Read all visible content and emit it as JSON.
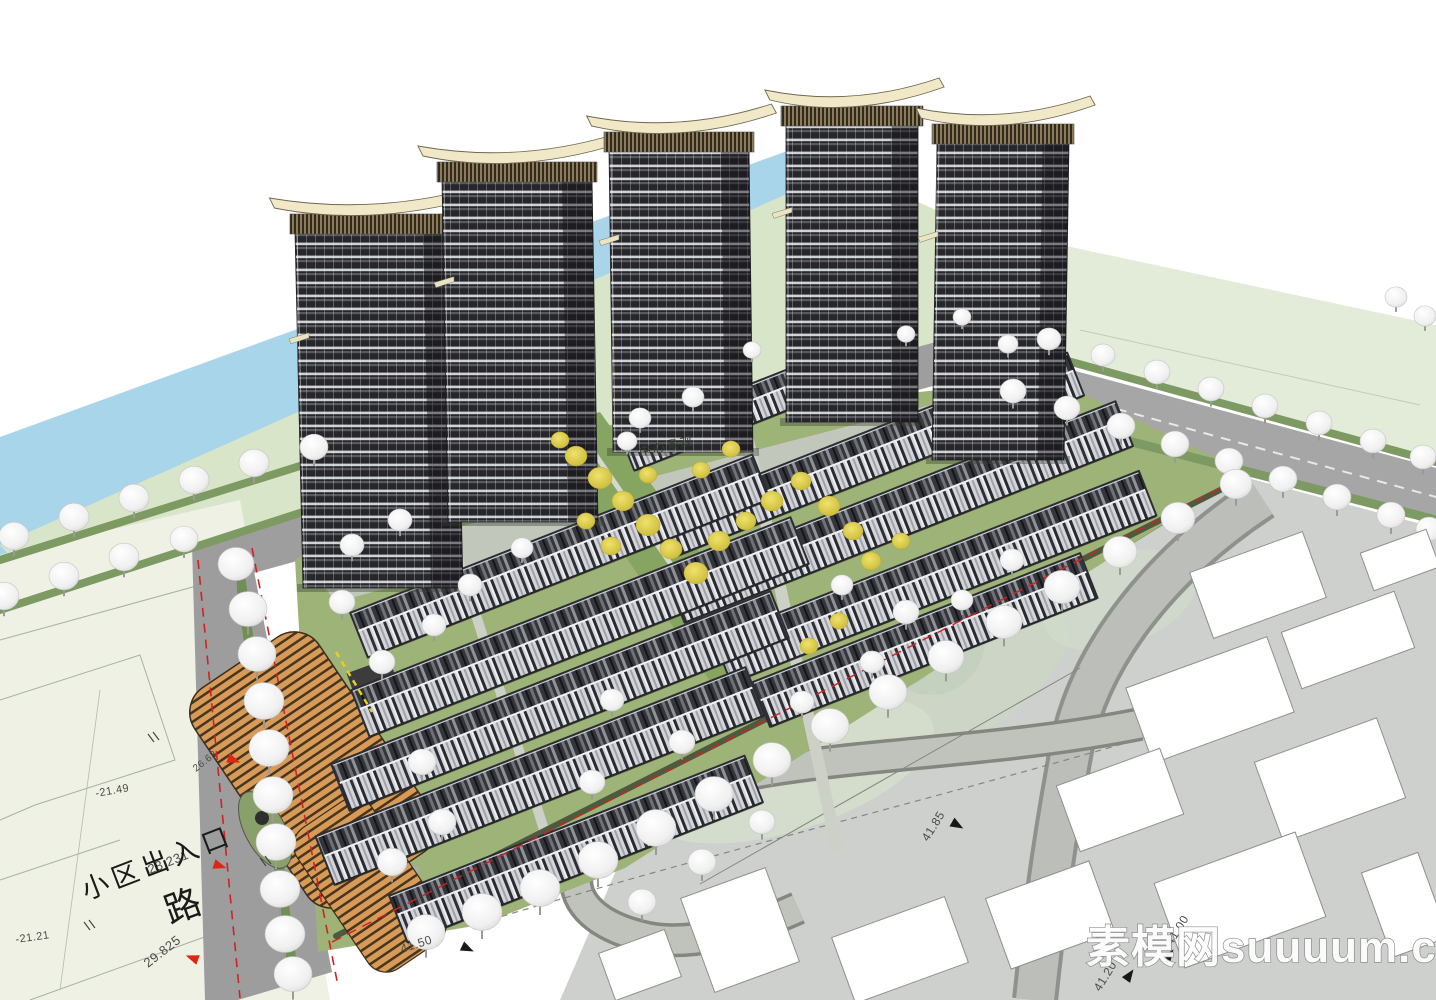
{
  "watermark": {
    "text": "素模网suuuum.com"
  },
  "labels": {
    "entrance": {
      "text": "小区出入口",
      "x": 86,
      "y": 900,
      "rot": -21,
      "size": 27
    },
    "road_char": {
      "text": "路",
      "x": 170,
      "y": 924,
      "rot": -20,
      "size": 36
    },
    "central": {
      "text": "中心景观",
      "x": 640,
      "y": 456,
      "rot": -12,
      "size": 12
    }
  },
  "elevations": [
    {
      "v": "-21.49",
      "x": 96,
      "y": 797,
      "rot": -10,
      "size": 11
    },
    {
      "v": "-21.21",
      "x": 16,
      "y": 943,
      "rot": -8,
      "size": 11
    },
    {
      "v": "28.231",
      "x": 150,
      "y": 874,
      "rot": -22,
      "size": 13,
      "tri": {
        "x": 214,
        "y": 864,
        "rot": 18,
        "c": "#e02515"
      }
    },
    {
      "v": "29.825",
      "x": 148,
      "y": 968,
      "rot": -38,
      "size": 13,
      "tri": {
        "x": 198,
        "y": 960,
        "rot": 200,
        "c": "#e02515"
      }
    },
    {
      "v": "26.63",
      "x": 196,
      "y": 772,
      "rot": -38,
      "size": 10,
      "tri": {
        "x": 228,
        "y": 758,
        "rot": 20,
        "c": "#e02515"
      }
    },
    {
      "v": "41.50",
      "x": 402,
      "y": 953,
      "rot": -18,
      "size": 12,
      "tri": {
        "x": 462,
        "y": 946,
        "rot": 25,
        "c": "#181818"
      }
    },
    {
      "v": "41.85",
      "x": 928,
      "y": 842,
      "rot": -58,
      "size": 12,
      "tri": {
        "x": 952,
        "y": 822,
        "rot": 30,
        "c": "#181818"
      }
    },
    {
      "v": "41.20",
      "x": 1100,
      "y": 992,
      "rot": -58,
      "size": 12,
      "tri": {
        "x": 1126,
        "y": 980,
        "rot": -55,
        "c": "#181818"
      }
    },
    {
      "v": "41.00",
      "x": 1172,
      "y": 946,
      "rot": -58,
      "size": 12,
      "tri": {
        "x": 1166,
        "y": 960,
        "rot": -55,
        "c": "#181818"
      }
    }
  ],
  "towers": [
    {
      "cx": 383,
      "w": 160,
      "base": 588,
      "top": 232,
      "lean": -8
    },
    {
      "cx": 523,
      "w": 150,
      "base": 522,
      "top": 180,
      "lean": -6
    },
    {
      "cx": 683,
      "w": 140,
      "base": 452,
      "top": 150,
      "lean": -4
    },
    {
      "cx": 852,
      "w": 132,
      "base": 422,
      "top": 124,
      "lean": 0
    },
    {
      "cx": 998,
      "w": 132,
      "base": 460,
      "top": 142,
      "lean": 5
    }
  ],
  "row_angle": -21.5,
  "townhouse_rows": [
    {
      "cx": 726,
      "cy": 414,
      "len": 210,
      "h": 36
    },
    {
      "cx": 870,
      "cy": 455,
      "len": 440,
      "h": 44
    },
    {
      "cx": 900,
      "cy": 512,
      "len": 480,
      "h": 46
    },
    {
      "cx": 935,
      "cy": 577,
      "len": 455,
      "h": 46
    },
    {
      "cx": 925,
      "cy": 640,
      "len": 350,
      "h": 46
    },
    {
      "cx": 560,
      "cy": 556,
      "len": 430,
      "h": 46
    },
    {
      "cx": 580,
      "cy": 627,
      "len": 470,
      "h": 48
    },
    {
      "cx": 560,
      "cy": 701,
      "len": 470,
      "h": 48
    },
    {
      "cx": 540,
      "cy": 776,
      "len": 460,
      "h": 50
    },
    {
      "cx": 576,
      "cy": 849,
      "len": 380,
      "h": 48
    }
  ],
  "footprint_angle": -20,
  "footprints": [
    [
      1258,
      585,
      120,
      70
    ],
    [
      1348,
      640,
      120,
      60
    ],
    [
      1210,
      700,
      150,
      80
    ],
    [
      1330,
      780,
      130,
      85
    ],
    [
      1120,
      800,
      110,
      70
    ],
    [
      1240,
      900,
      150,
      90
    ],
    [
      1050,
      915,
      110,
      75
    ],
    [
      900,
      950,
      120,
      70
    ],
    [
      740,
      930,
      90,
      100
    ],
    [
      640,
      965,
      70,
      50
    ],
    [
      1400,
      560,
      70,
      40
    ],
    [
      1405,
      905,
      60,
      90
    ]
  ],
  "trees_white": [
    [
      14,
      536,
      15
    ],
    [
      74,
      517,
      15
    ],
    [
      134,
      498,
      15
    ],
    [
      194,
      480,
      15
    ],
    [
      254,
      463,
      15
    ],
    [
      314,
      447,
      14
    ],
    [
      4,
      596,
      15
    ],
    [
      64,
      576,
      15
    ],
    [
      124,
      557,
      15
    ],
    [
      184,
      539,
      14
    ],
    [
      236,
      564,
      18
    ],
    [
      248,
      609,
      19
    ],
    [
      257,
      654,
      19
    ],
    [
      264,
      701,
      20
    ],
    [
      269,
      748,
      20
    ],
    [
      273,
      795,
      20
    ],
    [
      276,
      842,
      20
    ],
    [
      280,
      889,
      20
    ],
    [
      285,
      934,
      20
    ],
    [
      293,
      974,
      19
    ],
    [
      640,
      418,
      11
    ],
    [
      693,
      397,
      11
    ],
    [
      627,
      441,
      10
    ],
    [
      752,
      350,
      9
    ],
    [
      906,
      334,
      9
    ],
    [
      962,
      317,
      9
    ],
    [
      1008,
      344,
      10
    ],
    [
      1049,
      339,
      12
    ],
    [
      1103,
      355,
      12
    ],
    [
      1157,
      372,
      13
    ],
    [
      1211,
      389,
      13
    ],
    [
      1265,
      406,
      13
    ],
    [
      1319,
      423,
      13
    ],
    [
      1373,
      441,
      13
    ],
    [
      1423,
      457,
      13
    ],
    [
      1396,
      297,
      11
    ],
    [
      1425,
      316,
      11
    ],
    [
      1013,
      391,
      13
    ],
    [
      1067,
      408,
      13
    ],
    [
      1121,
      426,
      14
    ],
    [
      1175,
      444,
      14
    ],
    [
      1229,
      461,
      14
    ],
    [
      1283,
      479,
      14
    ],
    [
      1337,
      497,
      14
    ],
    [
      1391,
      515,
      14
    ],
    [
      1429,
      529,
      13
    ],
    [
      1236,
      484,
      16
    ],
    [
      1178,
      518,
      17
    ],
    [
      1120,
      552,
      17
    ],
    [
      1062,
      587,
      18
    ],
    [
      1004,
      622,
      18
    ],
    [
      946,
      657,
      18
    ],
    [
      888,
      692,
      19
    ],
    [
      830,
      726,
      19
    ],
    [
      772,
      760,
      19
    ],
    [
      714,
      794,
      19
    ],
    [
      656,
      828,
      20
    ],
    [
      598,
      860,
      20
    ],
    [
      540,
      888,
      20
    ],
    [
      482,
      912,
      20
    ],
    [
      426,
      932,
      19
    ],
    [
      906,
      612,
      13
    ],
    [
      1012,
      560,
      12
    ],
    [
      842,
      585,
      11
    ],
    [
      470,
      585,
      12
    ],
    [
      522,
      548,
      11
    ],
    [
      434,
      625,
      12
    ],
    [
      612,
      700,
      12
    ],
    [
      682,
      742,
      13
    ],
    [
      592,
      782,
      13
    ],
    [
      802,
      702,
      12
    ],
    [
      872,
      662,
      12
    ],
    [
      962,
      600,
      11
    ],
    [
      342,
      602,
      13
    ],
    [
      382,
      662,
      13
    ],
    [
      422,
      762,
      14
    ],
    [
      392,
      862,
      15
    ],
    [
      442,
      822,
      14
    ],
    [
      702,
      862,
      14
    ],
    [
      762,
      822,
      13
    ],
    [
      642,
      902,
      14
    ],
    [
      352,
      545,
      12
    ],
    [
      400,
      520,
      12
    ]
  ],
  "trees_yellow": [
    [
      576,
      456,
      11
    ],
    [
      600,
      478,
      12
    ],
    [
      623,
      501,
      11
    ],
    [
      648,
      525,
      12
    ],
    [
      671,
      549,
      11
    ],
    [
      696,
      573,
      12
    ],
    [
      611,
      546,
      10
    ],
    [
      586,
      521,
      9
    ],
    [
      719,
      541,
      11
    ],
    [
      746,
      521,
      10
    ],
    [
      772,
      501,
      11
    ],
    [
      801,
      481,
      10
    ],
    [
      829,
      506,
      11
    ],
    [
      853,
      531,
      10
    ],
    [
      701,
      470,
      9
    ],
    [
      731,
      449,
      9
    ],
    [
      871,
      561,
      10
    ],
    [
      901,
      541,
      9
    ],
    [
      839,
      621,
      9
    ],
    [
      809,
      646,
      9
    ],
    [
      560,
      440,
      9
    ],
    [
      648,
      475,
      9
    ]
  ],
  "colors": {
    "sky": "#ffffff",
    "river": "#a9d5ea",
    "bank": "#d9e5c8",
    "field": "#e3ecd9",
    "road": "#a2a4a1",
    "lawn": "#9db377",
    "axis_green": "#86a560",
    "tower_dark": "#26262b",
    "crown_cream": "#f0e8c6",
    "pool_blue": "#55bfe4",
    "canopy_tan": "#d89a57",
    "boundary_red": "#d42020",
    "plan_grey": "#cdd0cc",
    "footprint_white": "#ffffff"
  }
}
